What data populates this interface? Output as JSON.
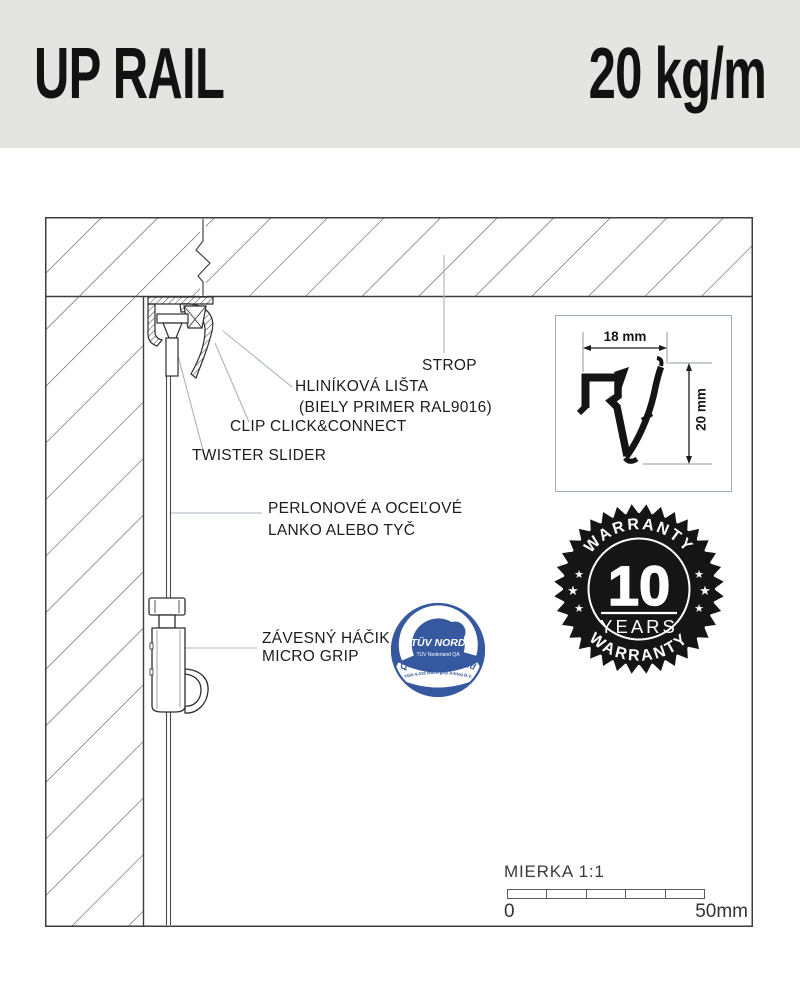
{
  "header": {
    "title": "UP RAIL",
    "capacity": "20 kg/m"
  },
  "diagram": {
    "labels": {
      "strop": "STROP",
      "rail_line1": "HLINÍKOVÁ LIŠTA",
      "rail_line2": "(BIELY PRIMER RAL9016)",
      "clip": "CLIP CLICK&CONNECT",
      "twister": "TWISTER SLIDER",
      "cable_line1": "PERLONOVÉ A OCEĽOVÉ",
      "cable_line2": "LANKO ALEBO TYČ",
      "hook_line1": "ZÁVESNÝ HÁČIK",
      "hook_line2": "MICRO GRIP"
    }
  },
  "dimension_box": {
    "width_label": "18 mm",
    "height_label": "20 mm"
  },
  "tuv_badge": {
    "brand": "TÜV NORD",
    "subtitle": "TÜV Nederland QA",
    "approval": "Quality Approved",
    "certificate": "7400-4-018 Micro grip Artiteq B.V."
  },
  "warranty_badge": {
    "top_text": "WARRANTY",
    "number": "10",
    "years_label": "YEARS",
    "bottom_text": "WARRANTY",
    "star": "★"
  },
  "scale": {
    "title": "MIERKA 1:1",
    "start_label": "0",
    "end_label": "50mm"
  },
  "colors": {
    "header_bg": "#e4e4e2",
    "drawing_line": "#3d3d3d",
    "leader_line": "#a8b4bc",
    "tuv_blue": "#35589f",
    "badge_black": "#151515"
  }
}
